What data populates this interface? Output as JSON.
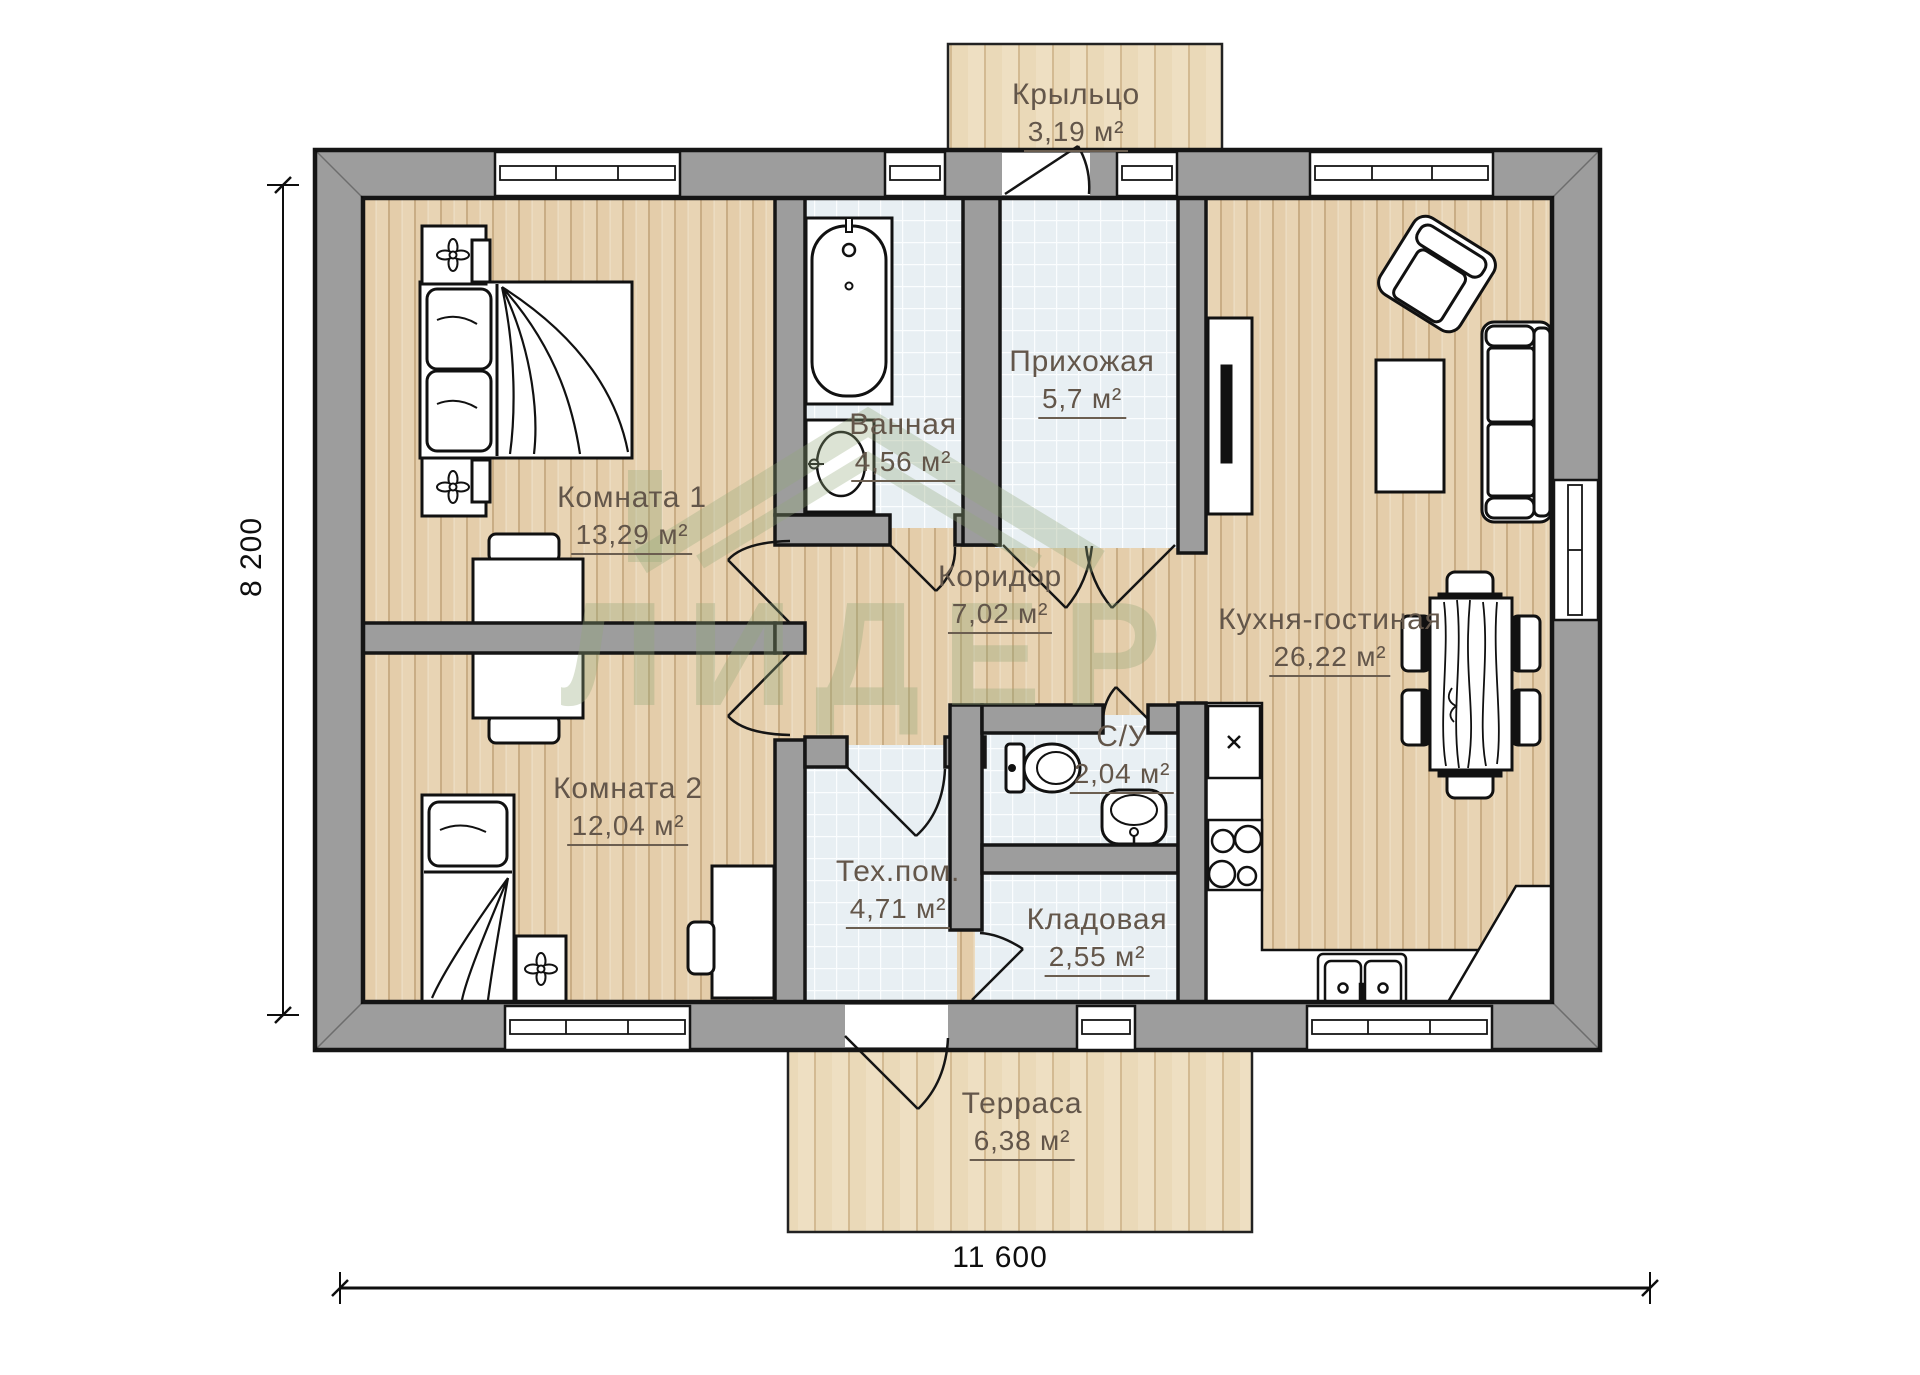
{
  "plan_title": "floor-plan",
  "rooms": [
    {
      "id": "porch",
      "name": "Крыльцо",
      "area": "3,19 м²",
      "floor": "deck"
    },
    {
      "id": "room1",
      "name": "Комната 1",
      "area": "13,29 м²",
      "floor": "wood"
    },
    {
      "id": "bathroom",
      "name": "Ванная",
      "area": "4,56 м²",
      "floor": "tile"
    },
    {
      "id": "hallway",
      "name": "Прихожая",
      "area": "5,7 м²",
      "floor": "tile"
    },
    {
      "id": "corridor",
      "name": "Коридор",
      "area": "7,02 м²",
      "floor": "wood"
    },
    {
      "id": "kitchen_living",
      "name": "Кухня-гостиная",
      "area": "26,22 м²",
      "floor": "wood"
    },
    {
      "id": "room2",
      "name": "Комната 2",
      "area": "12,04 м²",
      "floor": "wood"
    },
    {
      "id": "wc",
      "name": "С/У",
      "area": "2,04 м²",
      "floor": "tile"
    },
    {
      "id": "tech_room",
      "name": "Тех.пом.",
      "area": "4,71 м²",
      "floor": "tile"
    },
    {
      "id": "storage",
      "name": "Кладовая",
      "area": "2,55 м²",
      "floor": "tile"
    },
    {
      "id": "terrace",
      "name": "Терраса",
      "area": "6,38 м²",
      "floor": "deck"
    }
  ],
  "dimensions": {
    "width_label": "11 600",
    "height_label": "8 200"
  },
  "watermark": {
    "text": "ЛИДЕР"
  },
  "colors": {
    "wall_fill": "#9d9d9d",
    "wall_line": "#151515",
    "wood": "#e8d4b4",
    "tile": "#e8eff3",
    "deck": "#eedfc2",
    "label_text": "#63564a",
    "watermark": "#93a878"
  }
}
